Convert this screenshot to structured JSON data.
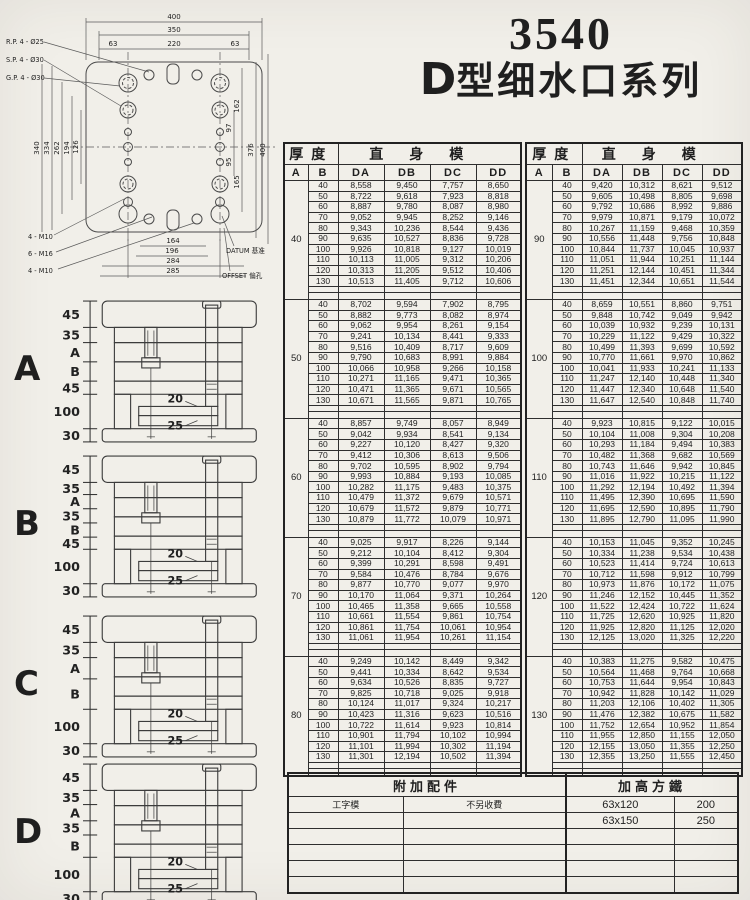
{
  "colors": {
    "paper": "#f1efe9",
    "ink": "#1f1f1f",
    "line": "#3c3c3c"
  },
  "title": {
    "model": "3540",
    "series_d": "D",
    "series_rest": "型细水口系列"
  },
  "plan": {
    "callouts_top": [
      "R.P. 4 - Ø25",
      "S.P. 4 - Ø30",
      "G.P. 4 - Ø30"
    ],
    "callouts_bottom": [
      "4 - M10",
      "6 - M16",
      "4 - M10"
    ],
    "callouts_right": [
      "DATUM 基准",
      "OFFSET 偏孔"
    ],
    "dims_top": [
      "400",
      "350",
      "63",
      "220",
      "63"
    ],
    "dims_left": [
      "340",
      "334",
      "262",
      "194",
      "126"
    ],
    "dims_right": [
      "162",
      "97",
      "95",
      "165",
      "376",
      "400"
    ],
    "dims_bottom": [
      "164",
      "196",
      "284",
      "285"
    ]
  },
  "sections": [
    {
      "label": "A",
      "dims": [
        "45",
        "35",
        "A",
        "B",
        "45",
        "100",
        "30"
      ],
      "inner": [
        "20",
        "25"
      ]
    },
    {
      "label": "B",
      "dims": [
        "45",
        "35",
        "A",
        "35",
        "B",
        "45",
        "100",
        "30"
      ],
      "inner": [
        "20",
        "25"
      ]
    },
    {
      "label": "C",
      "dims": [
        "45",
        "35",
        "A",
        "B",
        "100",
        "30"
      ],
      "inner": [
        "20",
        "25"
      ]
    },
    {
      "label": "D",
      "dims": [
        "45",
        "35",
        "A",
        "35",
        "B",
        "100",
        "30"
      ],
      "inner": [
        "20",
        "25"
      ]
    }
  ],
  "table": {
    "header": {
      "thickness": "厚度",
      "body": "直身模",
      "a": "A",
      "b": "B",
      "cols": [
        "DA",
        "DB",
        "DC",
        "DD"
      ]
    },
    "left_blocks": [
      {
        "a": "40",
        "rows": [
          [
            "40",
            "8,558",
            "9,450",
            "7,757",
            "8,650"
          ],
          [
            "50",
            "8,722",
            "9,618",
            "7,923",
            "8,818"
          ],
          [
            "60",
            "8,887",
            "9,780",
            "8,087",
            "8,980"
          ],
          [
            "70",
            "9,052",
            "9,945",
            "8,252",
            "9,146"
          ],
          [
            "80",
            "9,343",
            "10,236",
            "8,544",
            "9,436"
          ],
          [
            "90",
            "9,635",
            "10,527",
            "8,836",
            "9,728"
          ],
          [
            "100",
            "9,926",
            "10,818",
            "9,127",
            "10,019"
          ],
          [
            "110",
            "10,113",
            "11,005",
            "9,312",
            "10,206"
          ],
          [
            "120",
            "10,313",
            "11,205",
            "9,512",
            "10,406"
          ],
          [
            "130",
            "10,513",
            "11,405",
            "9,712",
            "10,606"
          ]
        ]
      },
      {
        "a": "50",
        "rows": [
          [
            "40",
            "8,702",
            "9,594",
            "7,902",
            "8,795"
          ],
          [
            "50",
            "8,882",
            "9,773",
            "8,082",
            "8,974"
          ],
          [
            "60",
            "9,062",
            "9,954",
            "8,261",
            "9,154"
          ],
          [
            "70",
            "9,241",
            "10,134",
            "8,441",
            "9,333"
          ],
          [
            "80",
            "9,516",
            "10,409",
            "8,717",
            "9,609"
          ],
          [
            "90",
            "9,790",
            "10,683",
            "8,991",
            "9,884"
          ],
          [
            "100",
            "10,066",
            "10,958",
            "9,266",
            "10,158"
          ],
          [
            "110",
            "10,271",
            "11,165",
            "9,471",
            "10,365"
          ],
          [
            "120",
            "10,471",
            "11,365",
            "9,671",
            "10,565"
          ],
          [
            "130",
            "10,671",
            "11,565",
            "9,871",
            "10,765"
          ]
        ]
      },
      {
        "a": "60",
        "rows": [
          [
            "40",
            "8,857",
            "9,749",
            "8,057",
            "8,949"
          ],
          [
            "50",
            "9,042",
            "9,934",
            "8,541",
            "9,134"
          ],
          [
            "60",
            "9,227",
            "10,120",
            "8,427",
            "9,320"
          ],
          [
            "70",
            "9,412",
            "10,306",
            "8,613",
            "9,506"
          ],
          [
            "80",
            "9,702",
            "10,595",
            "8,902",
            "9,794"
          ],
          [
            "90",
            "9,993",
            "10,884",
            "9,193",
            "10,085"
          ],
          [
            "100",
            "10,282",
            "11,175",
            "9,483",
            "10,375"
          ],
          [
            "110",
            "10,479",
            "11,372",
            "9,679",
            "10,571"
          ],
          [
            "120",
            "10,679",
            "11,572",
            "9,879",
            "10,771"
          ],
          [
            "130",
            "10,879",
            "11,772",
            "10,079",
            "10,971"
          ]
        ]
      },
      {
        "a": "70",
        "rows": [
          [
            "40",
            "9,025",
            "9,917",
            "8,226",
            "9,144"
          ],
          [
            "50",
            "9,212",
            "10,104",
            "8,412",
            "9,304"
          ],
          [
            "60",
            "9,399",
            "10,291",
            "8,598",
            "9,491"
          ],
          [
            "70",
            "9,584",
            "10,476",
            "8,784",
            "9,676"
          ],
          [
            "80",
            "9,877",
            "10,770",
            "9,077",
            "9,970"
          ],
          [
            "90",
            "10,170",
            "11,064",
            "9,371",
            "10,264"
          ],
          [
            "100",
            "10,465",
            "11,358",
            "9,665",
            "10,558"
          ],
          [
            "110",
            "10,661",
            "11,554",
            "9,861",
            "10,754"
          ],
          [
            "120",
            "10,861",
            "11,754",
            "10,061",
            "10,954"
          ],
          [
            "130",
            "11,061",
            "11,954",
            "10,261",
            "11,154"
          ]
        ]
      },
      {
        "a": "80",
        "rows": [
          [
            "40",
            "9,249",
            "10,142",
            "8,449",
            "9,342"
          ],
          [
            "50",
            "9,441",
            "10,334",
            "8,642",
            "9,534"
          ],
          [
            "60",
            "9,634",
            "10,526",
            "8,835",
            "9,727"
          ],
          [
            "70",
            "9,825",
            "10,718",
            "9,025",
            "9,918"
          ],
          [
            "80",
            "10,124",
            "11,017",
            "9,324",
            "10,217"
          ],
          [
            "90",
            "10,423",
            "11,316",
            "9,623",
            "10,516"
          ],
          [
            "100",
            "10,722",
            "11,614",
            "9,923",
            "10,814"
          ],
          [
            "110",
            "10,901",
            "11,794",
            "10,102",
            "10,994"
          ],
          [
            "120",
            "11,101",
            "11,994",
            "10,302",
            "11,194"
          ],
          [
            "130",
            "11,301",
            "12,194",
            "10,502",
            "11,394"
          ]
        ]
      }
    ],
    "right_blocks": [
      {
        "a": "90",
        "rows": [
          [
            "40",
            "9,420",
            "10,312",
            "8,621",
            "9,512"
          ],
          [
            "50",
            "9,605",
            "10,498",
            "8,805",
            "9,698"
          ],
          [
            "60",
            "9,792",
            "10,686",
            "8,992",
            "9,886"
          ],
          [
            "70",
            "9,979",
            "10,871",
            "9,179",
            "10,072"
          ],
          [
            "80",
            "10,267",
            "11,159",
            "9,468",
            "10,359"
          ],
          [
            "90",
            "10,556",
            "11,448",
            "9,756",
            "10,848"
          ],
          [
            "100",
            "10,844",
            "11,737",
            "10,045",
            "10,937"
          ],
          [
            "110",
            "11,051",
            "11,944",
            "10,251",
            "11,144"
          ],
          [
            "120",
            "11,251",
            "12,144",
            "10,451",
            "11,344"
          ],
          [
            "130",
            "11,451",
            "12,344",
            "10,651",
            "11,544"
          ]
        ]
      },
      {
        "a": "100",
        "rows": [
          [
            "40",
            "8,659",
            "10,551",
            "8,860",
            "9,751"
          ],
          [
            "50",
            "9,848",
            "10,742",
            "9,049",
            "9,942"
          ],
          [
            "60",
            "10,039",
            "10,932",
            "9,239",
            "10,131"
          ],
          [
            "70",
            "10,229",
            "11,122",
            "9,429",
            "10,322"
          ],
          [
            "80",
            "10,499",
            "11,393",
            "9,699",
            "10,592"
          ],
          [
            "90",
            "10,770",
            "11,661",
            "9,970",
            "10,862"
          ],
          [
            "100",
            "10,041",
            "11,933",
            "10,241",
            "11,133"
          ],
          [
            "110",
            "11,247",
            "12,140",
            "10,448",
            "11,340"
          ],
          [
            "120",
            "11,447",
            "12,340",
            "10,648",
            "11,540"
          ],
          [
            "130",
            "11,647",
            "12,540",
            "10,848",
            "11,740"
          ]
        ]
      },
      {
        "a": "110",
        "rows": [
          [
            "40",
            "9,923",
            "10,815",
            "9,122",
            "10,015"
          ],
          [
            "50",
            "10,104",
            "11,008",
            "9,304",
            "10,208"
          ],
          [
            "60",
            "10,293",
            "11,184",
            "9,494",
            "10,383"
          ],
          [
            "70",
            "10,482",
            "11,368",
            "9,682",
            "10,569"
          ],
          [
            "80",
            "10,743",
            "11,646",
            "9,942",
            "10,845"
          ],
          [
            "90",
            "11,016",
            "11,922",
            "10,215",
            "11,122"
          ],
          [
            "100",
            "11,292",
            "12,194",
            "10,492",
            "11,394"
          ],
          [
            "110",
            "11,495",
            "12,390",
            "10,695",
            "11,590"
          ],
          [
            "120",
            "11,695",
            "12,590",
            "10,895",
            "11,790"
          ],
          [
            "130",
            "11,895",
            "12,790",
            "11,095",
            "11,990"
          ]
        ]
      },
      {
        "a": "120",
        "rows": [
          [
            "40",
            "10,153",
            "11,045",
            "9,352",
            "10,245"
          ],
          [
            "50",
            "10,334",
            "11,238",
            "9,534",
            "10,438"
          ],
          [
            "60",
            "10,523",
            "11,414",
            "9,724",
            "10,613"
          ],
          [
            "70",
            "10,712",
            "11,598",
            "9,912",
            "10,799"
          ],
          [
            "80",
            "10,973",
            "11,876",
            "10,172",
            "11,075"
          ],
          [
            "90",
            "11,246",
            "12,152",
            "10,445",
            "11,352"
          ],
          [
            "100",
            "11,522",
            "12,424",
            "10,722",
            "11,624"
          ],
          [
            "110",
            "11,725",
            "12,620",
            "10,925",
            "11,820"
          ],
          [
            "120",
            "11,925",
            "12,820",
            "11,125",
            "12,020"
          ],
          [
            "130",
            "12,125",
            "13,020",
            "11,325",
            "12,220"
          ]
        ]
      },
      {
        "a": "130",
        "rows": [
          [
            "40",
            "10,383",
            "11,275",
            "9,582",
            "10,475"
          ],
          [
            "50",
            "10,564",
            "11,468",
            "9,764",
            "10,668"
          ],
          [
            "60",
            "10,753",
            "11,644",
            "9,954",
            "10,843"
          ],
          [
            "70",
            "10,942",
            "11,828",
            "10,142",
            "11,029"
          ],
          [
            "80",
            "11,203",
            "12,106",
            "10,402",
            "11,305"
          ],
          [
            "90",
            "11,476",
            "12,382",
            "10,675",
            "11,582"
          ],
          [
            "100",
            "11,752",
            "12,654",
            "10,952",
            "11,854"
          ],
          [
            "110",
            "11,955",
            "12,850",
            "11,155",
            "12,050"
          ],
          [
            "120",
            "12,155",
            "13,050",
            "11,355",
            "12,250"
          ],
          [
            "130",
            "12,355",
            "13,250",
            "11,555",
            "12,450"
          ]
        ]
      }
    ]
  },
  "accessories": {
    "headers": [
      "附加配件",
      "加高方鐵"
    ],
    "rows": [
      [
        "工字模",
        "不另收費",
        "63x120",
        "200"
      ],
      [
        "",
        "",
        "63x150",
        "250"
      ],
      [
        "",
        "",
        "",
        ""
      ],
      [
        "",
        "",
        "",
        ""
      ],
      [
        "",
        "",
        "",
        ""
      ],
      [
        "",
        "",
        "",
        ""
      ]
    ]
  }
}
